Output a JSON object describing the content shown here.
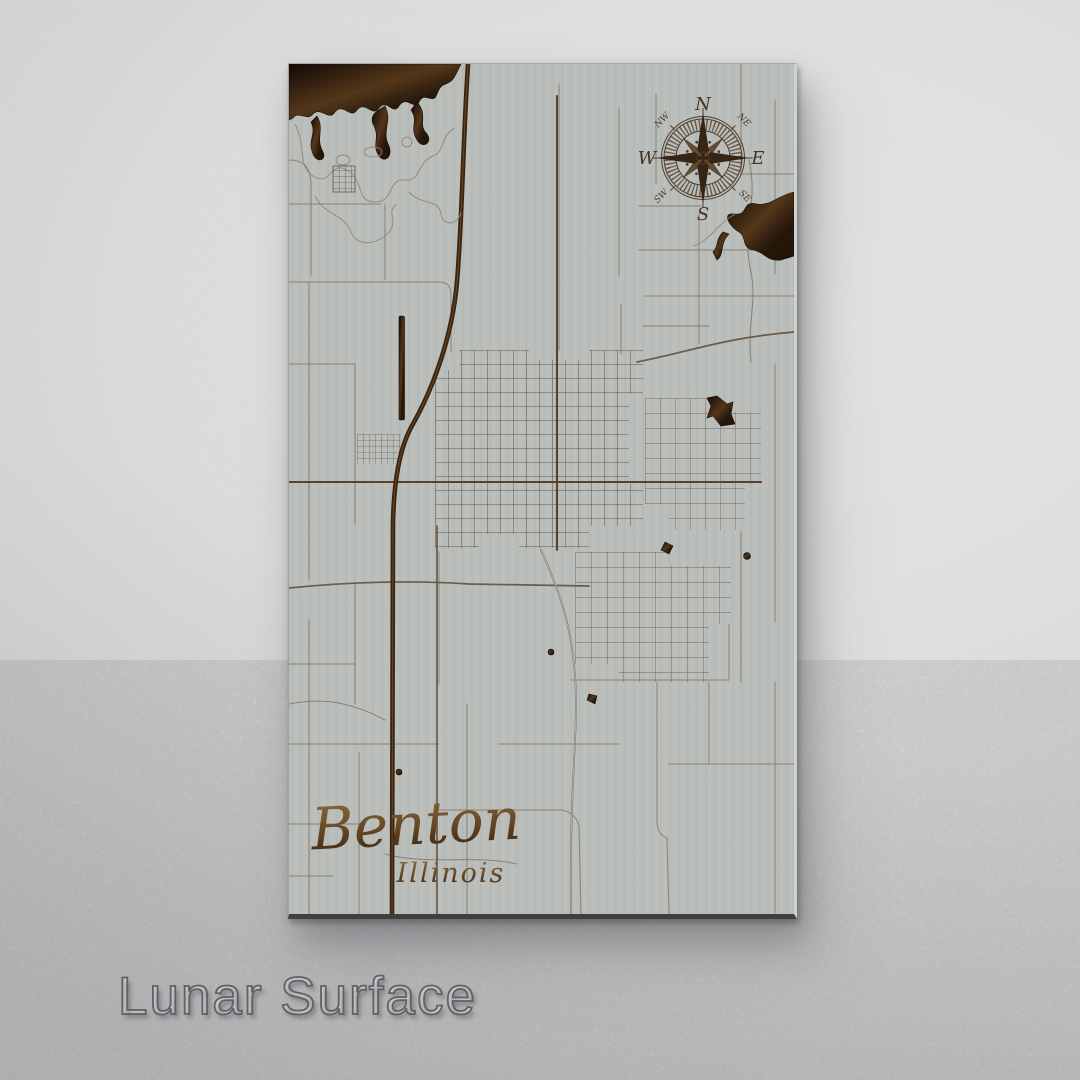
{
  "finish_label": "Lunar Surface",
  "map": {
    "city": "Benton",
    "state": "Illinois",
    "compass": {
      "n": "N",
      "e": "E",
      "s": "S",
      "w": "W",
      "nw": "NW",
      "ne": "NE",
      "sw": "SW",
      "se": "SE"
    }
  },
  "colors": {
    "wall_light": "#fafaf9",
    "wall_dark": "#d6d8da",
    "panel": "#c5c9c6",
    "street_thin": "#8e8275",
    "street_major": "#6f5b45",
    "street_artery": "#5c4630",
    "interstate": "#40260e",
    "burn_dark": "#2a1a0d",
    "burn_mid": "#5a3a1c",
    "title_light": "#9a7444",
    "title_dark": "#3a2310",
    "label_outline": "#5f6165"
  }
}
